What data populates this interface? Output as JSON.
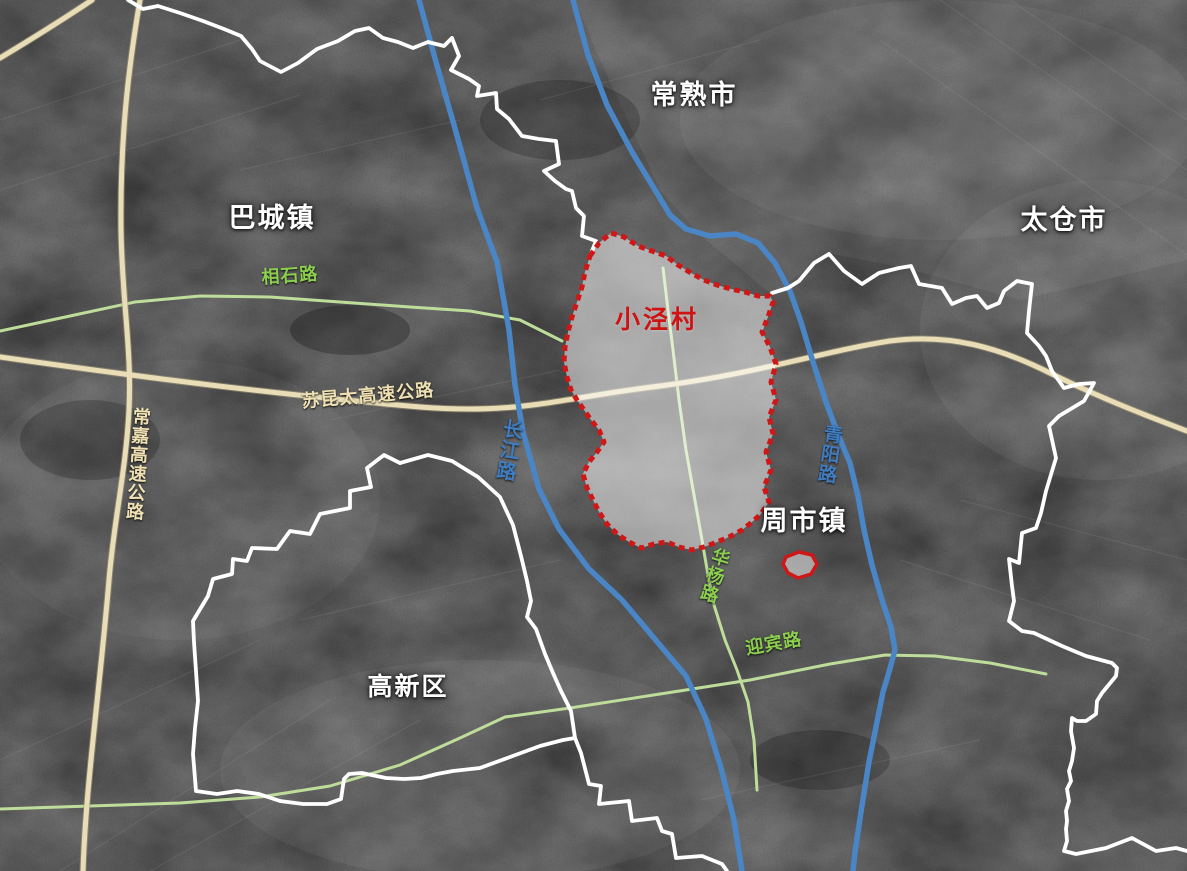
{
  "map": {
    "labels": {
      "changshu": "常熟市",
      "taicang": "太仓市",
      "bacheng": "巴城镇",
      "zhoushi": "周市镇",
      "gaoxin": "高新区",
      "village": "小泾村",
      "xiangshi": "相石路",
      "sukuntai": "苏昆太高速公路",
      "changjia": "常嘉高速公路",
      "changjiang": "长江路",
      "qingyang": "青阳路",
      "huayang": "华杨路",
      "yingbin": "迎宾路"
    },
    "colors": {
      "boundary_white": "#ffffff",
      "village_red": "#d01717",
      "village_fill": "rgba(255,255,255,0.5)",
      "river_blue": "#4a85c5",
      "expressway_tan": "#e9ddb8",
      "expressway_edge": "#a29877",
      "road_green": "#bedd9a",
      "label_green": "#8ccf4f",
      "label_blue": "#3f7cc0",
      "label_tan": "#eee0b2",
      "label_white": "#ffffff"
    }
  }
}
